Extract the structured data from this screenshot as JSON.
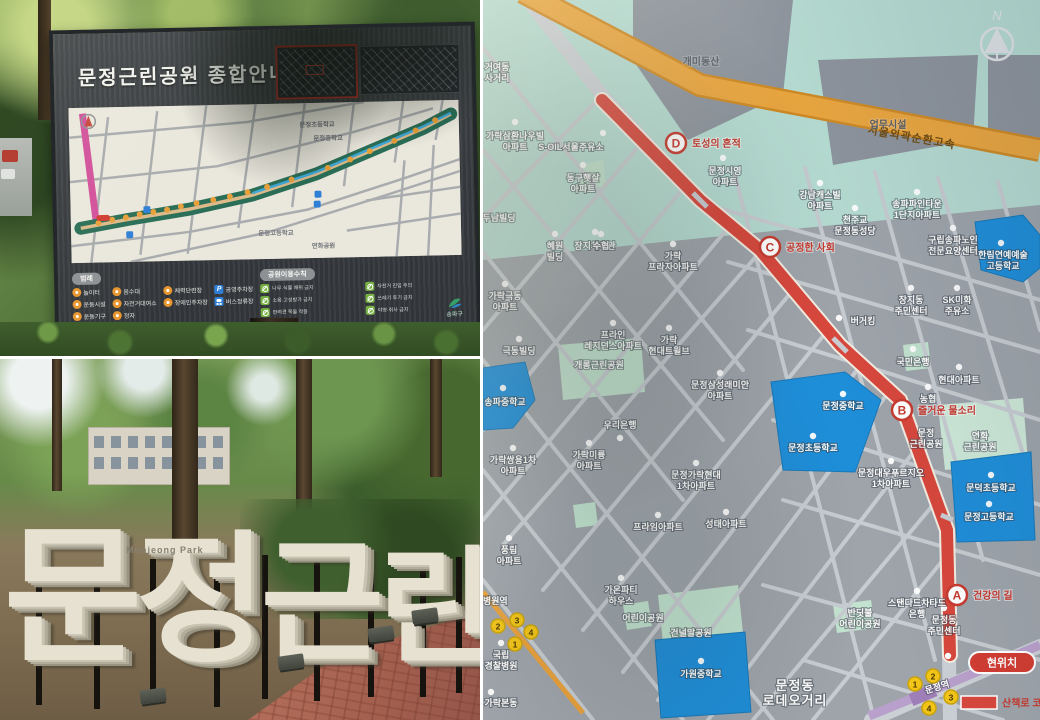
{
  "sign_photo": {
    "title": "문정근린공원 종합안내도",
    "map_labels": {
      "elem": "문정초등학교",
      "middle": "문정중학교",
      "high": "문정고등학교",
      "park": "연화공원"
    },
    "legend_title": "범례",
    "legend_items": [
      "놀이터",
      "음수대",
      "체력단련장",
      "운동시설",
      "자전거대여소",
      "장애인주차장",
      "운동기구",
      "정자"
    ],
    "p_icon": "P",
    "parking": "공영주차장",
    "bus": "버스정류장",
    "rules_title": "공원이용수칙",
    "rules": [
      "나무·식물 채취 금지",
      "소음·고성방가 금지",
      "반려견 목줄 착용",
      "자전거 진입 주의",
      "쓰레기 투기 금지",
      "야영·취사 금지"
    ],
    "logo": "송파구"
  },
  "entrance_photo": {
    "letters": [
      "문",
      "정",
      "근",
      "린",
      "공",
      "원"
    ],
    "subtitle": "Munjeong Park"
  },
  "map": {
    "compass": "N",
    "highway": "서울외곽순환고속",
    "course_legend": "산책로 코스",
    "here": "현위치",
    "exits": [
      "1",
      "2",
      "3",
      "4"
    ],
    "stations": {
      "line3": "경찰병원역",
      "line8": "문정역"
    },
    "badges": [
      {
        "letter": "A",
        "name": "건강의 길"
      },
      {
        "letter": "B",
        "name": "즐거운 물소리"
      },
      {
        "letter": "C",
        "name": "공정한 사회"
      },
      {
        "letter": "D",
        "name": "토성의 흔적"
      }
    ],
    "labels": {
      "geoyeo": [
        "거여동",
        "사거리"
      ],
      "gaemi_hill": "개미동산",
      "office": "업무시설",
      "jangji_gym": "장지체육관",
      "garak_samhwan": [
        "가락삼환나우빌",
        "아파트"
      ],
      "s_oil": "S-OIL서울주유소",
      "donggu": [
        "동구햇살",
        "아파트"
      ],
      "siyoung": [
        "문정시영",
        "아파트"
      ],
      "dunam": "두남빌딩",
      "hyewon": [
        "혜원",
        "빌딩"
      ],
      "suhyup": "수협",
      "garak_plaza": [
        "가락",
        "프라자아파트"
      ],
      "garak_geukdong": [
        "가락극동",
        "아파트"
      ],
      "purine": [
        "프라인",
        "레지던스아파트"
      ],
      "garak_hyundai": [
        "가락",
        "현대트윌브"
      ],
      "geukdong_bldg": "극동빌딩",
      "gaerong_park": "개롱근린공원",
      "raemian": [
        "문정삼성래미안",
        "아파트"
      ],
      "songpa_middle": "송파중학교",
      "catholic": [
        "천주교",
        "문정동성당"
      ],
      "gangnam_castle": [
        "강남캐스빌",
        "아파트"
      ],
      "pinetown": [
        "송파파인타운",
        "1단지아파트"
      ],
      "nursing": [
        "구립송파노인",
        "전문요양센터"
      ],
      "hallim": [
        "한림연예예술",
        "고등학교"
      ],
      "jangji_center": [
        "장지동",
        "주민센터"
      ],
      "sk_gas": [
        "SK미화",
        "주유소"
      ],
      "burger_king": "버거킹",
      "kb_bank": "국민은행",
      "hyundai_apt": "현대아파트",
      "woori_bank": "우리은행",
      "ssangyong": [
        "가락쌍용1차",
        "아파트"
      ],
      "miryung": [
        "가락미륭",
        "아파트"
      ],
      "mj_garak_hyundai": [
        "문정가락현대",
        "1차아파트"
      ],
      "prime": "프라임아파트",
      "seongtae": "성태아파트",
      "mj_middle": "문정중학교",
      "mj_elem": "문정초등학교",
      "nonghyup": "농협",
      "mj_park": [
        "문정",
        "근린공원"
      ],
      "yeonhwa_park": [
        "연화",
        "근린공원"
      ],
      "daewoo": [
        "문정대우푸르지오",
        "1차아파트"
      ],
      "mundeok_elem": "문덕초등학교",
      "mj_high": "문정고등학교",
      "pungrim": [
        "풍림",
        "아파트"
      ],
      "gaon": [
        "가온파티",
        "하우스"
      ],
      "police_hosp": [
        "국립",
        "경찰병원"
      ],
      "children_park": "어린이공원",
      "geonneolmal": "건널말공원",
      "mj_dong_center": [
        "문정동",
        "주민센터"
      ],
      "sc_bank": [
        "스탠다드차타드",
        "은행"
      ],
      "firefly": [
        "반딧불",
        "어린이공원"
      ],
      "gawon_middle": "가원중학교",
      "rodeo": [
        "문정동",
        "로데오거리"
      ],
      "garak_bondong": "가락본동"
    }
  }
}
